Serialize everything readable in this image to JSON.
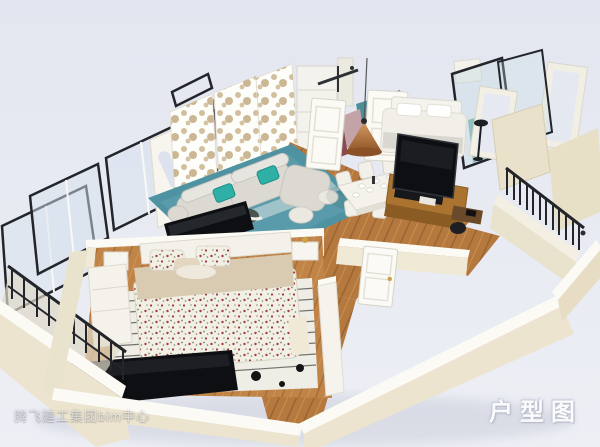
{
  "meta": {
    "type": "3d-floorplan-render",
    "view": "axonometric cutaway of two-bedroom apartment"
  },
  "overlay": {
    "watermark": "腾飞建工集团bim中心",
    "caption": "户型图"
  },
  "colors": {
    "background_top": "#e3e6f0",
    "background_bottom": "#edeff5",
    "wall_cream": "#efe9d6",
    "wall_front": "#ece4cf",
    "wall_top_white": "#fbfaf4",
    "wood_floor": "#b5793f",
    "wood_floor_light": "#c08449",
    "rug_teal": "#4f93a3",
    "pillow_teal": "#2fb0a6",
    "frame_dark": "#23252a",
    "tv_black": "#0e0f12",
    "copper": "#b87a48",
    "accent_maroon": "#8a4a52",
    "counter_teal": "#4d8f99",
    "glass_teal": "#7ab3b0",
    "sofa_gray": "#dbd9d2",
    "cabinet_wood": "#aa7430"
  }
}
